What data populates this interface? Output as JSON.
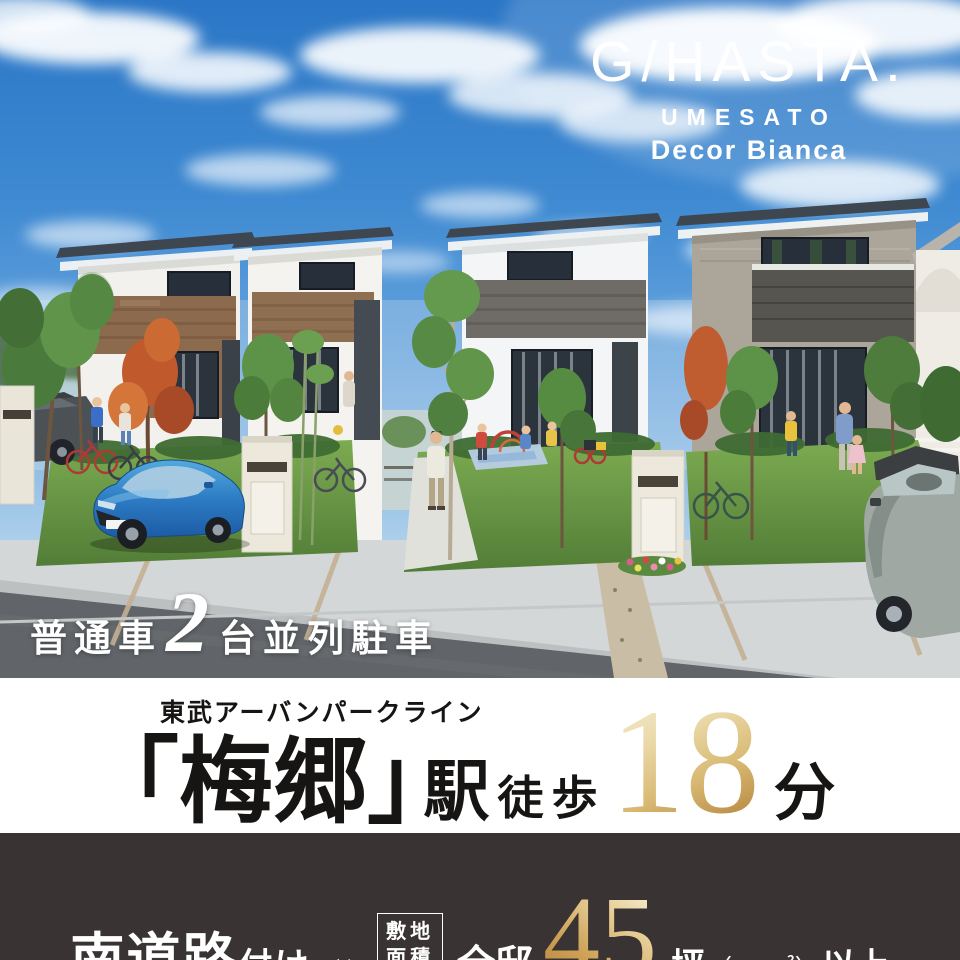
{
  "logo": {
    "brand": "G/HASTA.",
    "location": "UMESATO",
    "series": "Decor Bianca"
  },
  "parking": {
    "vehicle_type": "普通車",
    "count": "2",
    "label": "台並列駐車"
  },
  "station_access": {
    "rail_line": "東武アーバンパークライン",
    "bracket_open": "「",
    "station_name": "梅郷",
    "bracket_close": "」",
    "station_suffix": "駅",
    "walk_label": "徒歩",
    "walk_minutes": "18",
    "minutes_unit": "分"
  },
  "site_features": {
    "road_direction": "南道路",
    "road_suffix": "付け",
    "multiply_sign": "×",
    "site_area_label_line1": "敷地",
    "site_area_label_line2": "面積",
    "all_residences": "全邸",
    "area_tsubo": "45",
    "tsubo_unit": "坪",
    "area_note": "（150㎡）",
    "minimum_suffix": "以上"
  },
  "colors": {
    "sky_blue": "#2e7ccb",
    "accent_gold_dark": "#b3823c",
    "accent_gold_light": "#f5ecd3",
    "dark_band_bg": "#393433",
    "white_band_bg": "#ffffff",
    "text_white": "#ffffff",
    "text_black": "#171513"
  }
}
